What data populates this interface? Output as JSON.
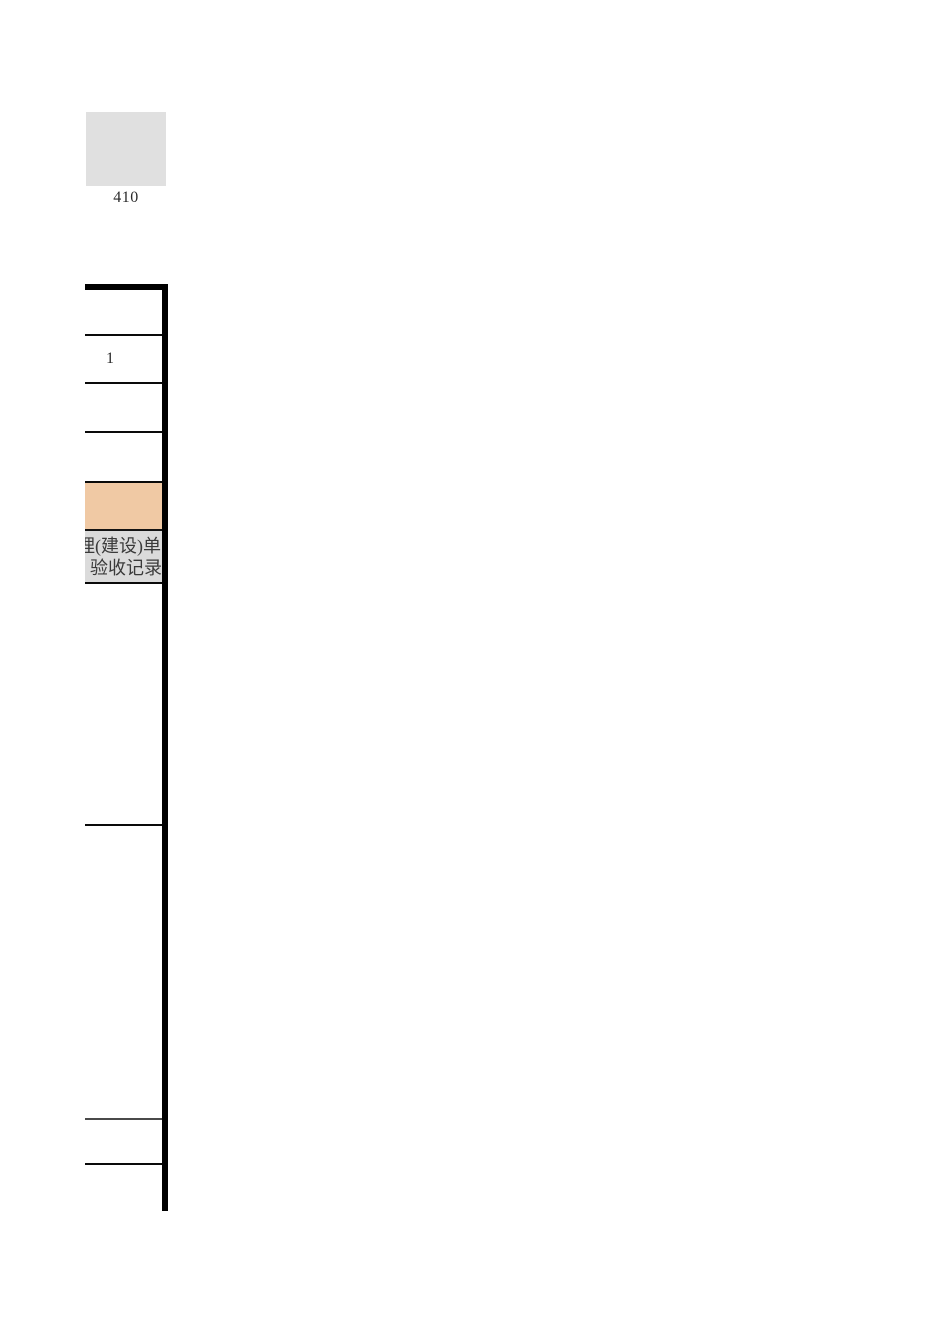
{
  "page": {
    "background": "#ffffff",
    "description_colors": {
      "placeholder_fill": "#e0e0e0",
      "table_border": "#000000",
      "highlight_fill": "#f0c9a4",
      "header_fill": "#dbdbdb"
    }
  },
  "figure": {
    "caption": "410",
    "placeholder_fill": "#e0e0e0"
  },
  "table": {
    "border_color": "#000000",
    "rows": [
      {
        "text": ""
      },
      {
        "text": "1"
      },
      {
        "text": ""
      },
      {
        "text": ""
      },
      {
        "text": "",
        "fill": "#f0c9a4"
      },
      {
        "fill": "#dbdbdb",
        "text_lines": {
          "line1": "理(建设)单",
          "line2": "验收记录"
        }
      },
      {
        "text": ""
      },
      {
        "text": ""
      },
      {
        "text": ""
      },
      {
        "text": ""
      }
    ]
  }
}
